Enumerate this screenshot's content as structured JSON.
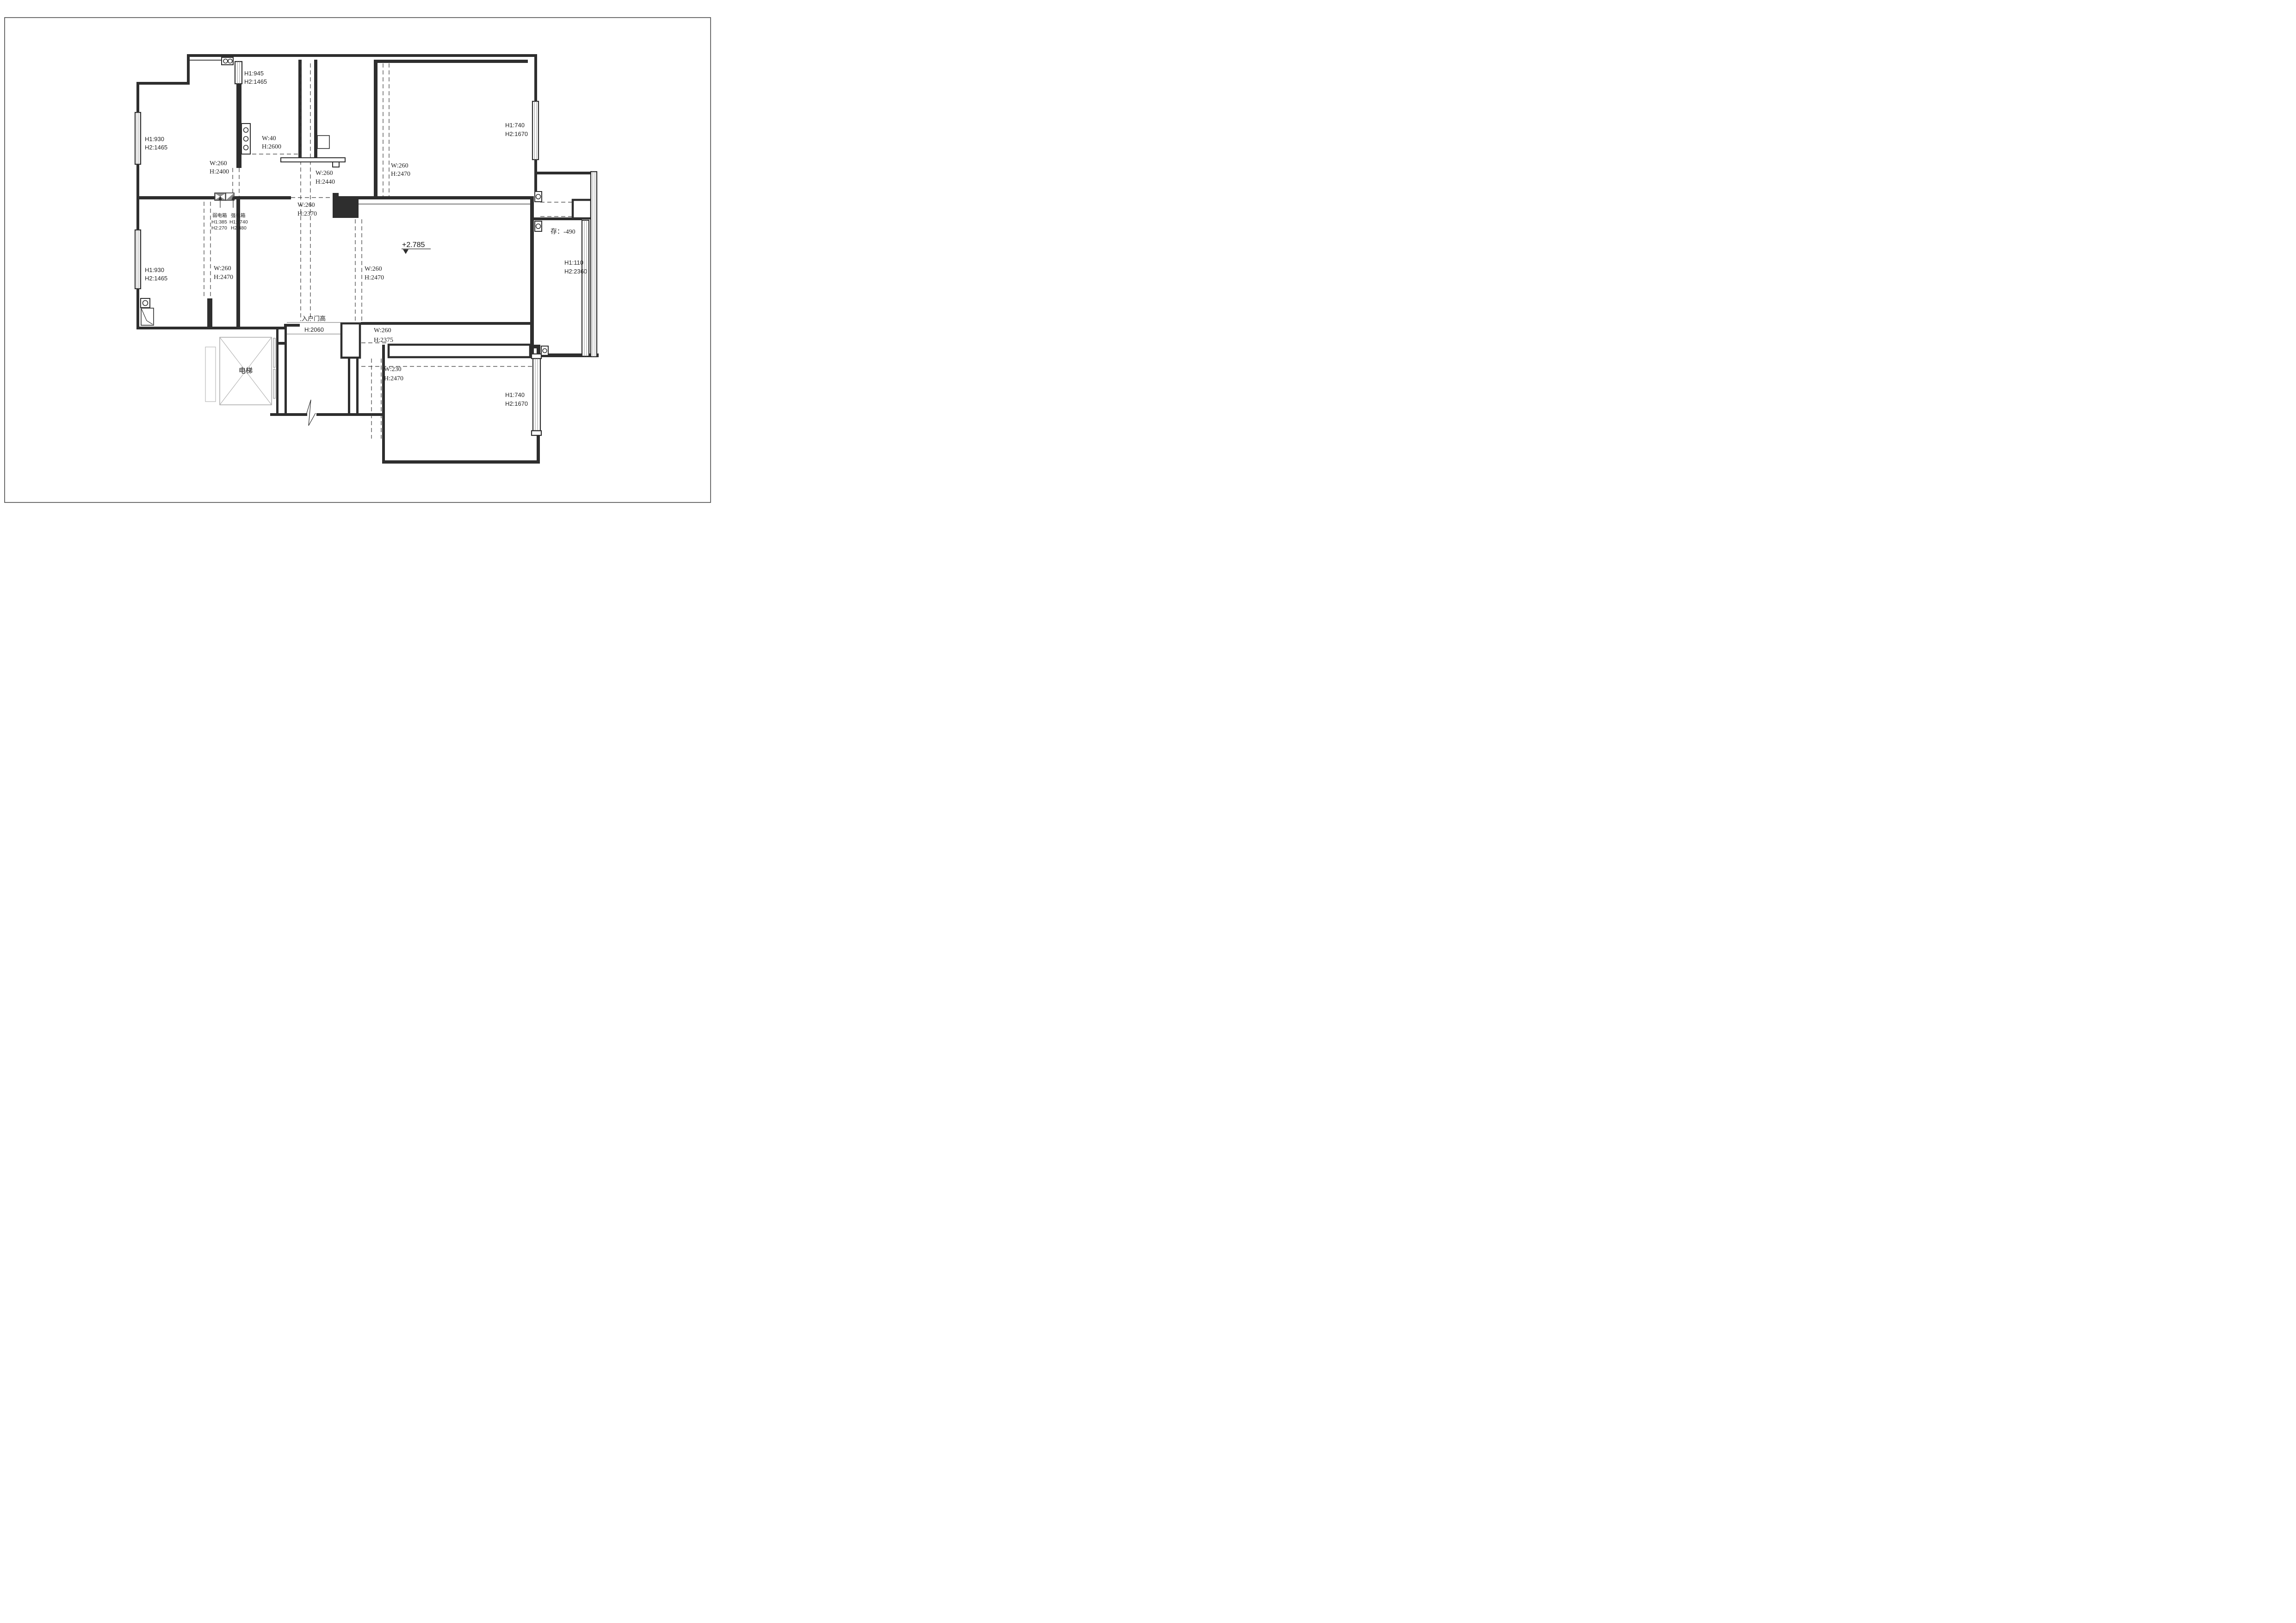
{
  "drawing": {
    "kind": "residential floor plan with opening/window height annotations",
    "level_mark": "+2.785",
    "colors": {
      "line": "#2e2e2e",
      "light_gray": "#9a9a9a",
      "box_fill": "#8a8a8a",
      "background": "#ffffff"
    }
  },
  "ann": {
    "win_tl": {
      "l1": "H1:945",
      "l2": "H2:1465"
    },
    "part40": {
      "l1": "W:40",
      "l2": "H:2600"
    },
    "win_lt": {
      "l1": "H1:930",
      "l2": "H2:1465"
    },
    "open2400": {
      "l1": "W:260",
      "l2": "H:2400"
    },
    "open2440": {
      "l1": "W:260",
      "l2": "H:2440"
    },
    "open2470t": {
      "l1": "W:260",
      "l2": "H:2470"
    },
    "win_tr": {
      "l1": "H1:740",
      "l2": "H2:1670"
    },
    "open2370": {
      "l1": "W:260",
      "l2": "H:2370"
    },
    "weak": {
      "name": "弱电箱",
      "h1": "H1:385",
      "h2": "H2:270"
    },
    "strong": {
      "name": "强电箱",
      "h1": "H1:1740",
      "h2": "H2:480"
    },
    "level": {
      "value": "+2.785"
    },
    "storage": {
      "text": "存：-490"
    },
    "win_r": {
      "l1": "H1:110",
      "l2": "H2:2360"
    },
    "win_lb": {
      "l1": "H1:930",
      "l2": "H2:1465"
    },
    "open2470l": {
      "l1": "W:260",
      "l2": "H:2470"
    },
    "open2470liv": {
      "l1": "W:260",
      "l2": "H:2470"
    },
    "entry": {
      "title": "入户门高",
      "h": "H:2060"
    },
    "open2375": {
      "l1": "W:260",
      "l2": "H:2375"
    },
    "open230": {
      "l1": "W:230",
      "l2": "H:2470"
    },
    "elevator": {
      "label": "电梯"
    },
    "win_br": {
      "l1": "H1:740",
      "l2": "H2:1670"
    }
  }
}
